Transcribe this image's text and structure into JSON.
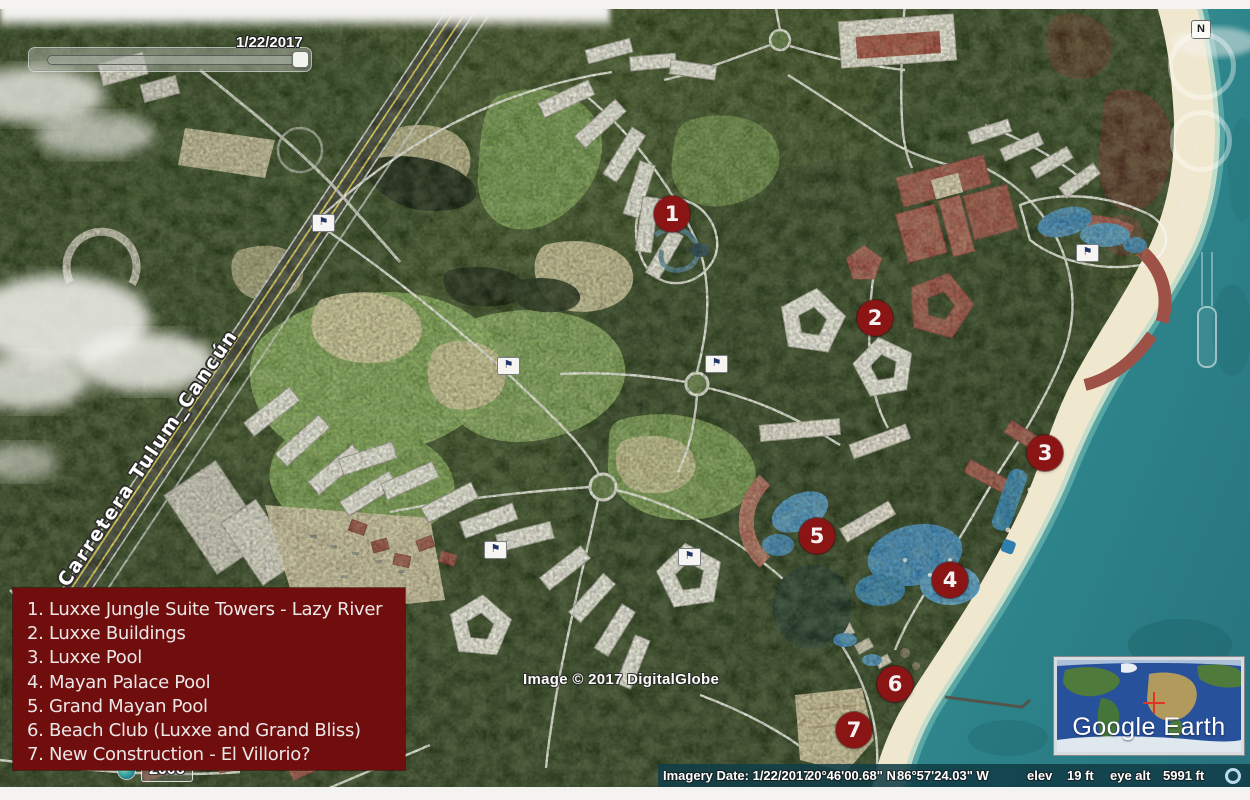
{
  "ui": {
    "timeline": {
      "date": "1/22/2017"
    },
    "compass_north_label": "N",
    "historical_imagery_year": "2006"
  },
  "map": {
    "road_label": "Carretera Tulum_Cancún",
    "copyright": "Image © 2017 DigitalGlobe"
  },
  "markers": [
    {
      "number": "1"
    },
    {
      "number": "2"
    },
    {
      "number": "3"
    },
    {
      "number": "4"
    },
    {
      "number": "5"
    },
    {
      "number": "6"
    },
    {
      "number": "7"
    }
  ],
  "legend": {
    "items": [
      "1. Luxxe Jungle Suite Towers - Lazy River",
      "2. Luxxe Buildings",
      "3. Luxxe Pool",
      "4. Mayan Palace Pool",
      "5. Grand Mayan Pool",
      "6. Beach Club (Luxxe and Grand Bliss)",
      "7. New Construction - El Villorio?"
    ]
  },
  "status_bar": {
    "imagery_date": "Imagery Date: 1/22/2017",
    "latitude": "20°46'00.68\" N",
    "longitude": "86°57'24.03\" W",
    "elev_label": "elev",
    "elevation": "19 ft",
    "eye_alt_label": "eye alt",
    "eye_altitude": "5991 ft"
  },
  "branding": {
    "logo_text": "Google Earth"
  },
  "icons": {
    "golf_flag": "⚑"
  },
  "colors": {
    "legend_background": "#700E0E",
    "marker_fill": "#8B1414",
    "status_bar_background": "#113E48",
    "ocean": "#2E7F87",
    "highway_yellow": "#E6CF4E"
  }
}
